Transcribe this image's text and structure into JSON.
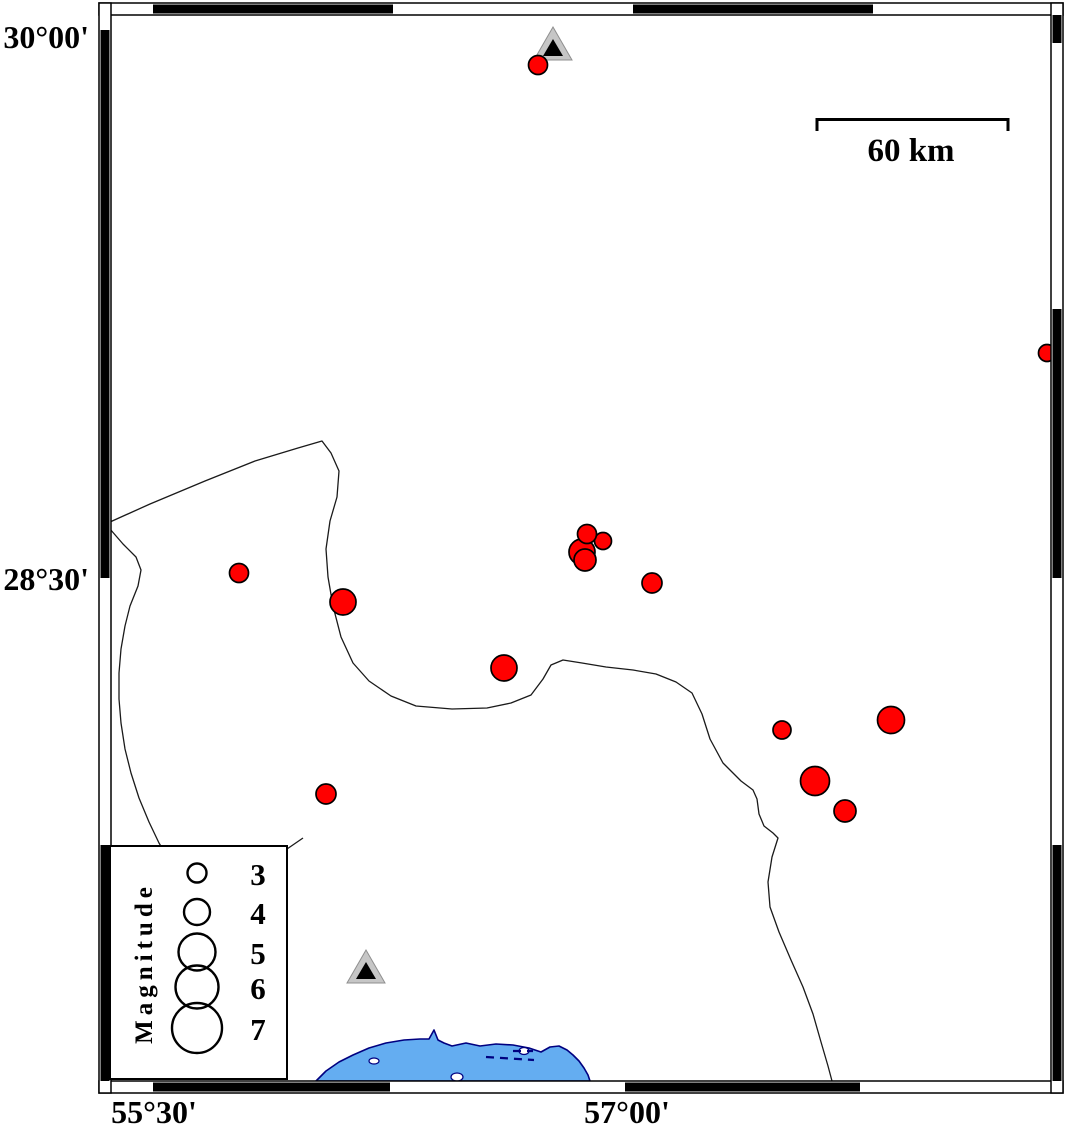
{
  "map": {
    "frame": {
      "axis_labels": {
        "left": [
          "30°00'",
          "28°30'"
        ],
        "bottom": [
          "55°30'",
          "57°00'"
        ]
      }
    },
    "scale_bar": {
      "label": "60 km"
    },
    "legend": {
      "title": "Magnitude",
      "entries": [
        {
          "label": "3",
          "r": 9.5,
          "y": 873
        },
        {
          "label": "4",
          "r": 13,
          "y": 912
        },
        {
          "label": "5",
          "r": 18.5,
          "y": 952
        },
        {
          "label": "6",
          "r": 21.5,
          "y": 987
        },
        {
          "label": "7",
          "r": 25,
          "y": 1028
        }
      ]
    },
    "earthquakes": [
      {
        "x": 538,
        "y": 65,
        "r": 9.5
      },
      {
        "x": 239,
        "y": 573,
        "r": 9.5
      },
      {
        "x": 343,
        "y": 602,
        "r": 13
      },
      {
        "x": 582,
        "y": 552,
        "r": 13
      },
      {
        "x": 585,
        "y": 560,
        "r": 11
      },
      {
        "x": 603,
        "y": 541,
        "r": 8.5
      },
      {
        "x": 587,
        "y": 534,
        "r": 9.5
      },
      {
        "x": 652,
        "y": 583,
        "r": 10
      },
      {
        "x": 504,
        "y": 668,
        "r": 13
      },
      {
        "x": 326,
        "y": 794,
        "r": 10
      },
      {
        "x": 782,
        "y": 730,
        "r": 9
      },
      {
        "x": 891,
        "y": 720,
        "r": 13.5
      },
      {
        "x": 815,
        "y": 781,
        "r": 14.5
      },
      {
        "x": 845,
        "y": 811,
        "r": 11
      },
      {
        "x": 1047,
        "y": 353,
        "r": 8.5
      }
    ],
    "stations": [
      {
        "x": 553,
        "y": 45
      },
      {
        "x": 366,
        "y": 968
      }
    ],
    "colors": {
      "earthquake_fill": "#ff0000",
      "earthquake_stroke": "#000000",
      "station_outer": "#c6c6c6",
      "station_inner": "#000000",
      "sea_fill": "#64adf1",
      "coastline": "#000080",
      "frame_black": "#000000"
    }
  }
}
